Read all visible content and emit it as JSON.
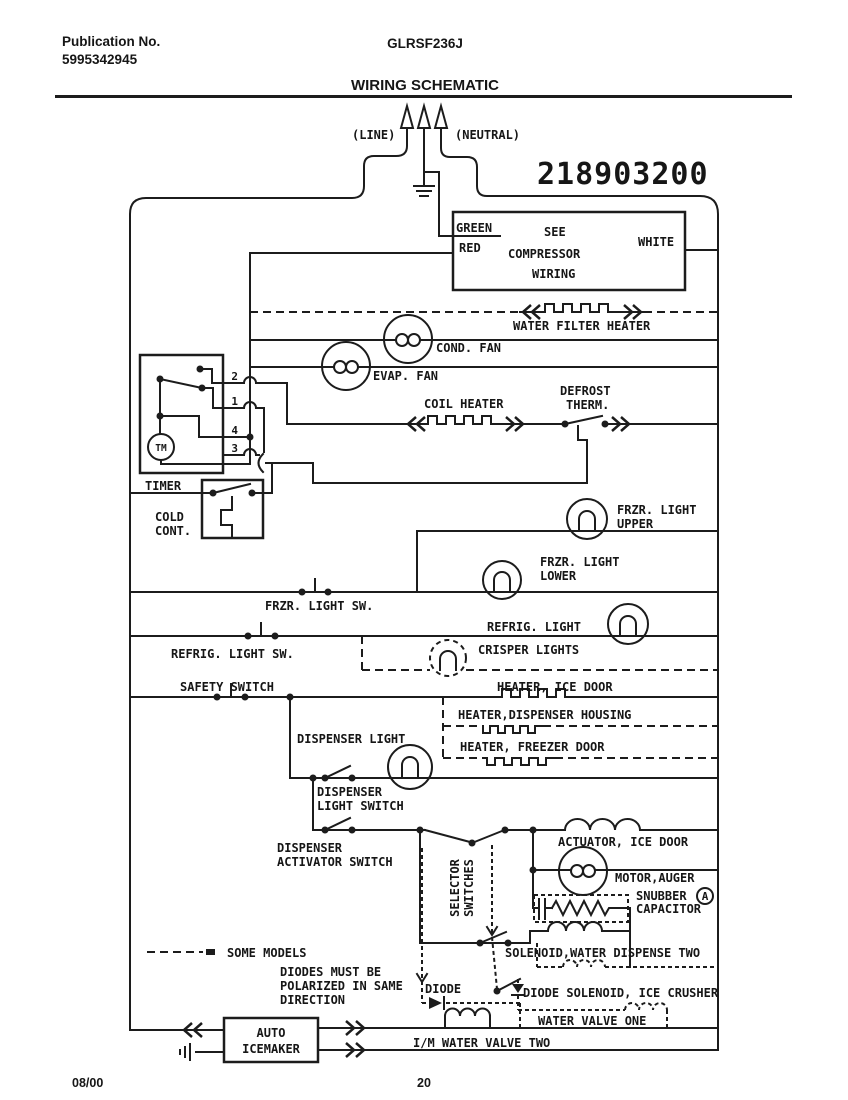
{
  "colors": {
    "ink": "#1c1c1c",
    "paper": "#ffffff"
  },
  "page": {
    "publication_label": "Publication No.",
    "publication_number": "5995342945",
    "model": "GLRSF236J",
    "title": "WIRING SCHEMATIC",
    "part_number": "218903200",
    "date_code": "08/00",
    "page_number": "20"
  },
  "power": {
    "line": "(LINE)",
    "neutral": "(NEUTRAL)"
  },
  "compressor": {
    "green": "GREEN",
    "red": "RED",
    "white": "WHITE",
    "note": [
      "SEE",
      "COMPRESSOR",
      "WIRING"
    ]
  },
  "labels": {
    "water_filter_heater": "WATER FILTER HEATER",
    "cond_fan": "COND. FAN",
    "evap_fan": "EVAP. FAN",
    "coil_heater": "COIL HEATER",
    "defrost_therm": [
      "DEFROST",
      "THERM."
    ],
    "timer": "TIMER",
    "timer_motor": "TM",
    "timer_pins": [
      "2",
      "1",
      "4",
      "3"
    ],
    "cold_control": [
      "COLD",
      "CONT."
    ],
    "frzr_light_upper": [
      "FRZR. LIGHT",
      "UPPER"
    ],
    "frzr_light_lower": [
      "FRZR. LIGHT",
      "LOWER"
    ],
    "frzr_light_sw": "FRZR. LIGHT SW.",
    "refrig_light": "REFRIG. LIGHT",
    "refrig_light_sw": "REFRIG. LIGHT SW.",
    "crisper_lights": "CRISPER LIGHTS",
    "safety_switch": "SAFETY SWITCH",
    "heater_ice_door": "HEATER, ICE DOOR",
    "heater_dispenser_housing": "HEATER,DISPENSER HOUSING",
    "heater_freezer_door": "HEATER, FREEZER DOOR",
    "dispenser_light": "DISPENSER LIGHT",
    "dispenser_light_switch": [
      "DISPENSER",
      "LIGHT SWITCH"
    ],
    "dispenser_activator_switch": [
      "DISPENSER",
      "ACTIVATOR SWITCH"
    ],
    "selector_switches": [
      "SELECTOR",
      "SWITCHES"
    ],
    "actuator_ice_door": "ACTUATOR, ICE DOOR",
    "motor_auger": "MOTOR,AUGER",
    "snubber_capacitor": [
      "SNUBBER",
      "CAPACITOR"
    ],
    "snubber_marker": "A",
    "solenoid_water_dispense": "SOLENOID,WATER DISPENSE TWO",
    "some_models": "SOME MODELS",
    "diodes_note": [
      "DIODES MUST BE",
      "POLARIZED IN SAME",
      "DIRECTION"
    ],
    "diode": "DIODE",
    "diode_solenoid_ice_crusher": "DIODE SOLENOID, ICE CRUSHER",
    "water_valve_one": "WATER VALVE ONE",
    "auto_icemaker": [
      "AUTO",
      "ICEMAKER"
    ],
    "im_water_valve_two": "I/M WATER VALVE TWO"
  }
}
